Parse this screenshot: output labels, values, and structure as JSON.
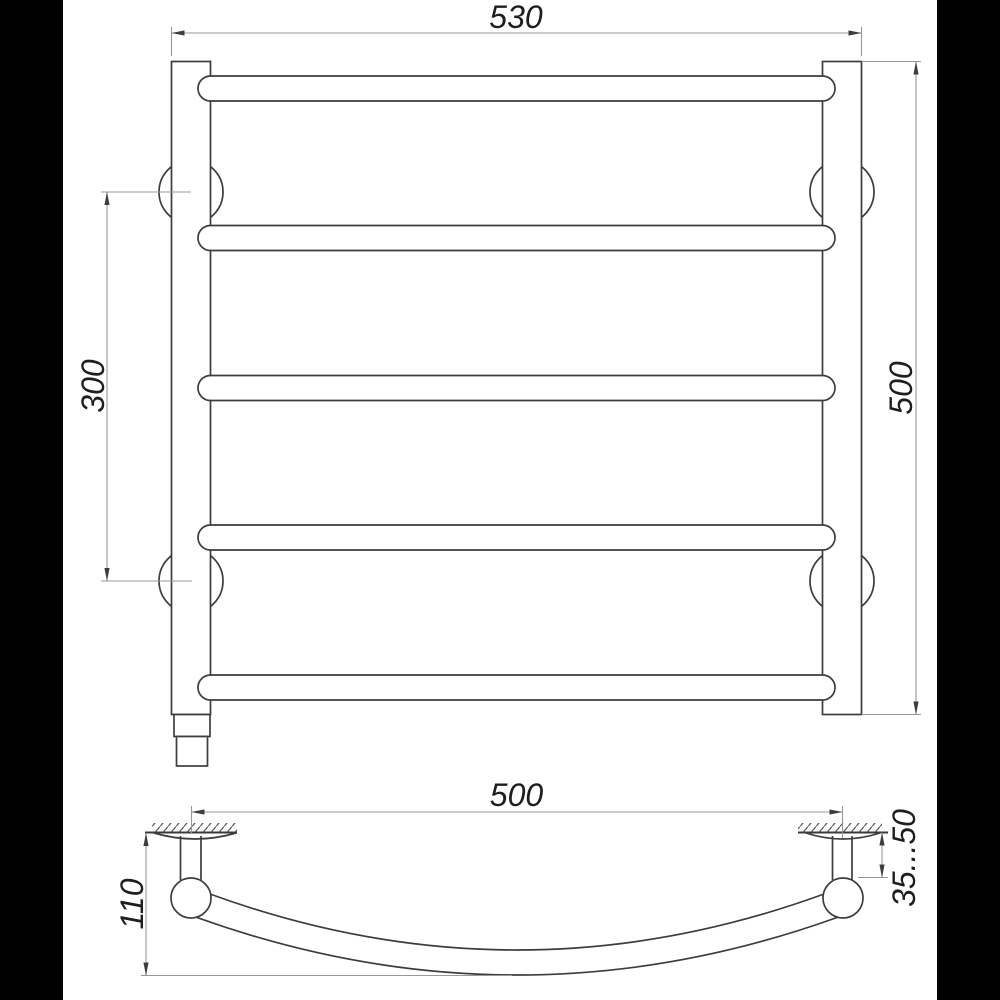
{
  "drawing": {
    "type": "technical-dimension-drawing",
    "views": {
      "front_view": {
        "bar_count": 5,
        "dim_width_label": "530",
        "dim_height_label": "500",
        "dim_bracket_spacing_label": "300"
      },
      "side_view": {
        "dim_span_label": "500",
        "dim_depth_label": "110",
        "dim_wall_clearance_label": "35...50"
      }
    },
    "colors": {
      "background": "#ffffff",
      "pillarbox": "#000000",
      "object_line": "#3d3d3d",
      "dimension_line": "#989898",
      "text": "#1e1e1e"
    }
  }
}
